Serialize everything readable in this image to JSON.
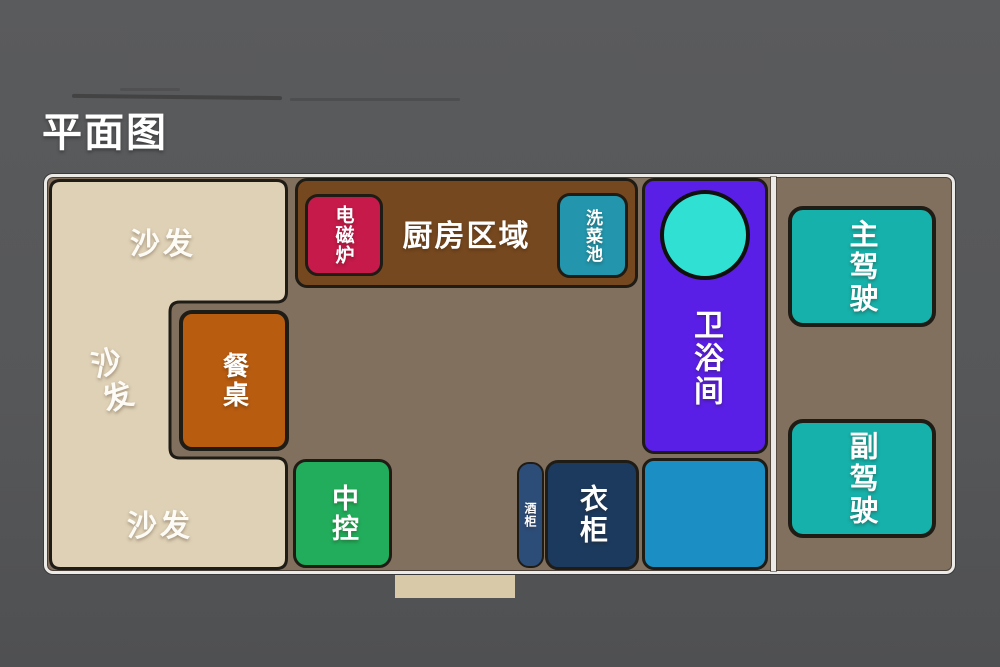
{
  "title": "平面图",
  "colors": {
    "background": "#565759",
    "floor": "#81705e",
    "outline": "#1f1b15",
    "wall_border": "#eceae6",
    "sofa": "#ded1b6",
    "kitchen": "#76481f",
    "induction": "#c51a4a",
    "sink": "#2396ad",
    "bathroom": "#5a1fe6",
    "toilet_circle": "#30e0d2",
    "seats": "#16b1aa",
    "dining_table": "#b85c10",
    "console": "#21ad5b",
    "wine_cabinet": "#2d4d79",
    "wardrobe": "#1c3a5e",
    "storage_box": "#1b8fc4",
    "entry_step": "#d8c9a8"
  },
  "rooms": {
    "sofa": {
      "labels": [
        "沙发",
        "沙发",
        "沙发"
      ],
      "color": "#ded1b6"
    },
    "kitchen": {
      "label": "厨房区域",
      "color": "#76481f"
    },
    "induction": {
      "label": "电磁炉",
      "color": "#c51a4a"
    },
    "sink": {
      "label": "洗菜池",
      "color": "#2396ad"
    },
    "bathroom": {
      "label": "卫浴间",
      "color": "#5a1fe6"
    },
    "driver": {
      "label": "主驾驶",
      "color": "#16b1aa"
    },
    "codriver": {
      "label": "副驾驶",
      "color": "#16b1aa"
    },
    "table": {
      "label": "餐桌",
      "color": "#b85c10"
    },
    "console": {
      "label": "中控",
      "color": "#21ad5b"
    },
    "wine": {
      "label": "酒柜",
      "color": "#2d4d79"
    },
    "wardrobe": {
      "label": "衣柜",
      "color": "#1c3a5e"
    }
  }
}
